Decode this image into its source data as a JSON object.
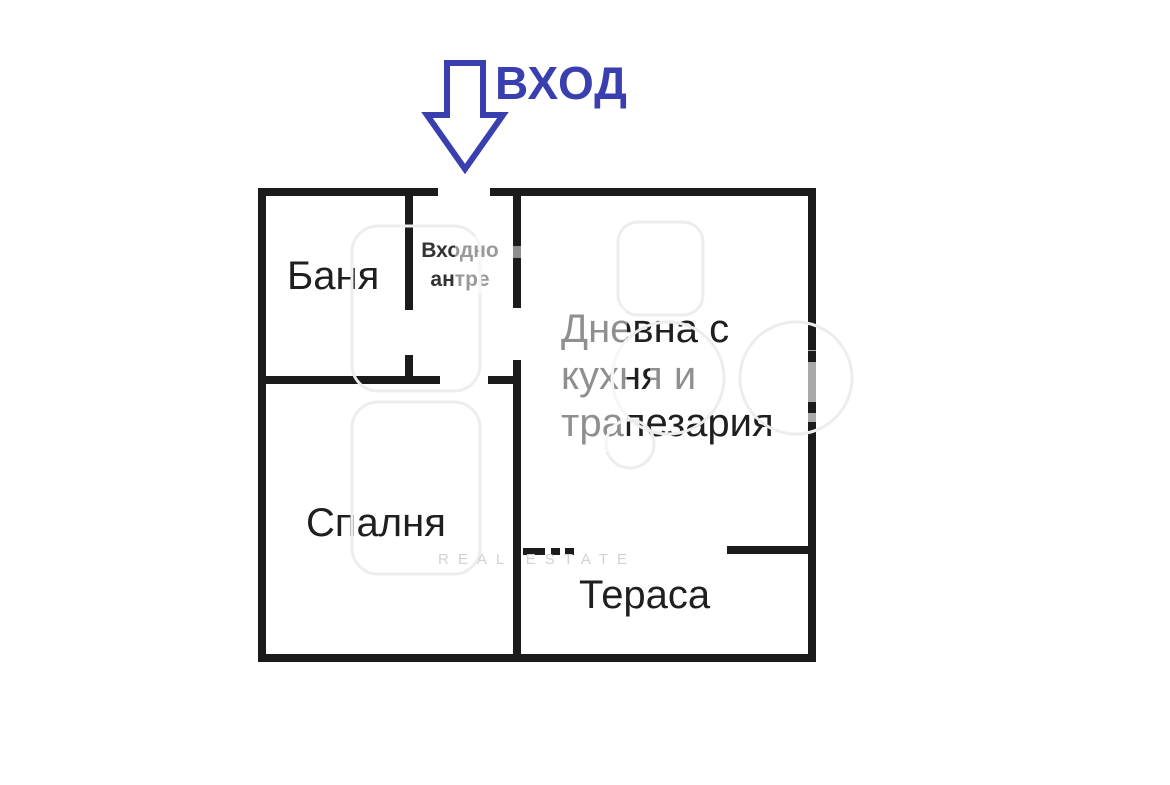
{
  "page": {
    "background": "#ffffff",
    "type_note": "apartment floor plan"
  },
  "colors": {
    "wall": "#1b1b1b",
    "window_gray": "#a9a9a9",
    "entrance_blue": "#3a3fb0",
    "watermark_outline": "#ededed",
    "watermark_text": "#d2d2d2"
  },
  "entrance": {
    "label": "ВХОД",
    "arrow_icon": "entrance-down-arrow"
  },
  "rooms": [
    {
      "name": "bathroom",
      "label": "Баня"
    },
    {
      "name": "entry-hall",
      "label": "Входно антре",
      "lines": [
        "Входно",
        "антре"
      ]
    },
    {
      "name": "living-kitchen-dining",
      "label": "Дневна с кухня и трапезария",
      "lines": [
        "Дневна с",
        "кухня и",
        "трапезария"
      ]
    },
    {
      "name": "bedroom",
      "label": "Спалня"
    },
    {
      "name": "terrace",
      "label": "Тераса"
    }
  ],
  "watermark": {
    "text": "REAL ESTATE"
  }
}
